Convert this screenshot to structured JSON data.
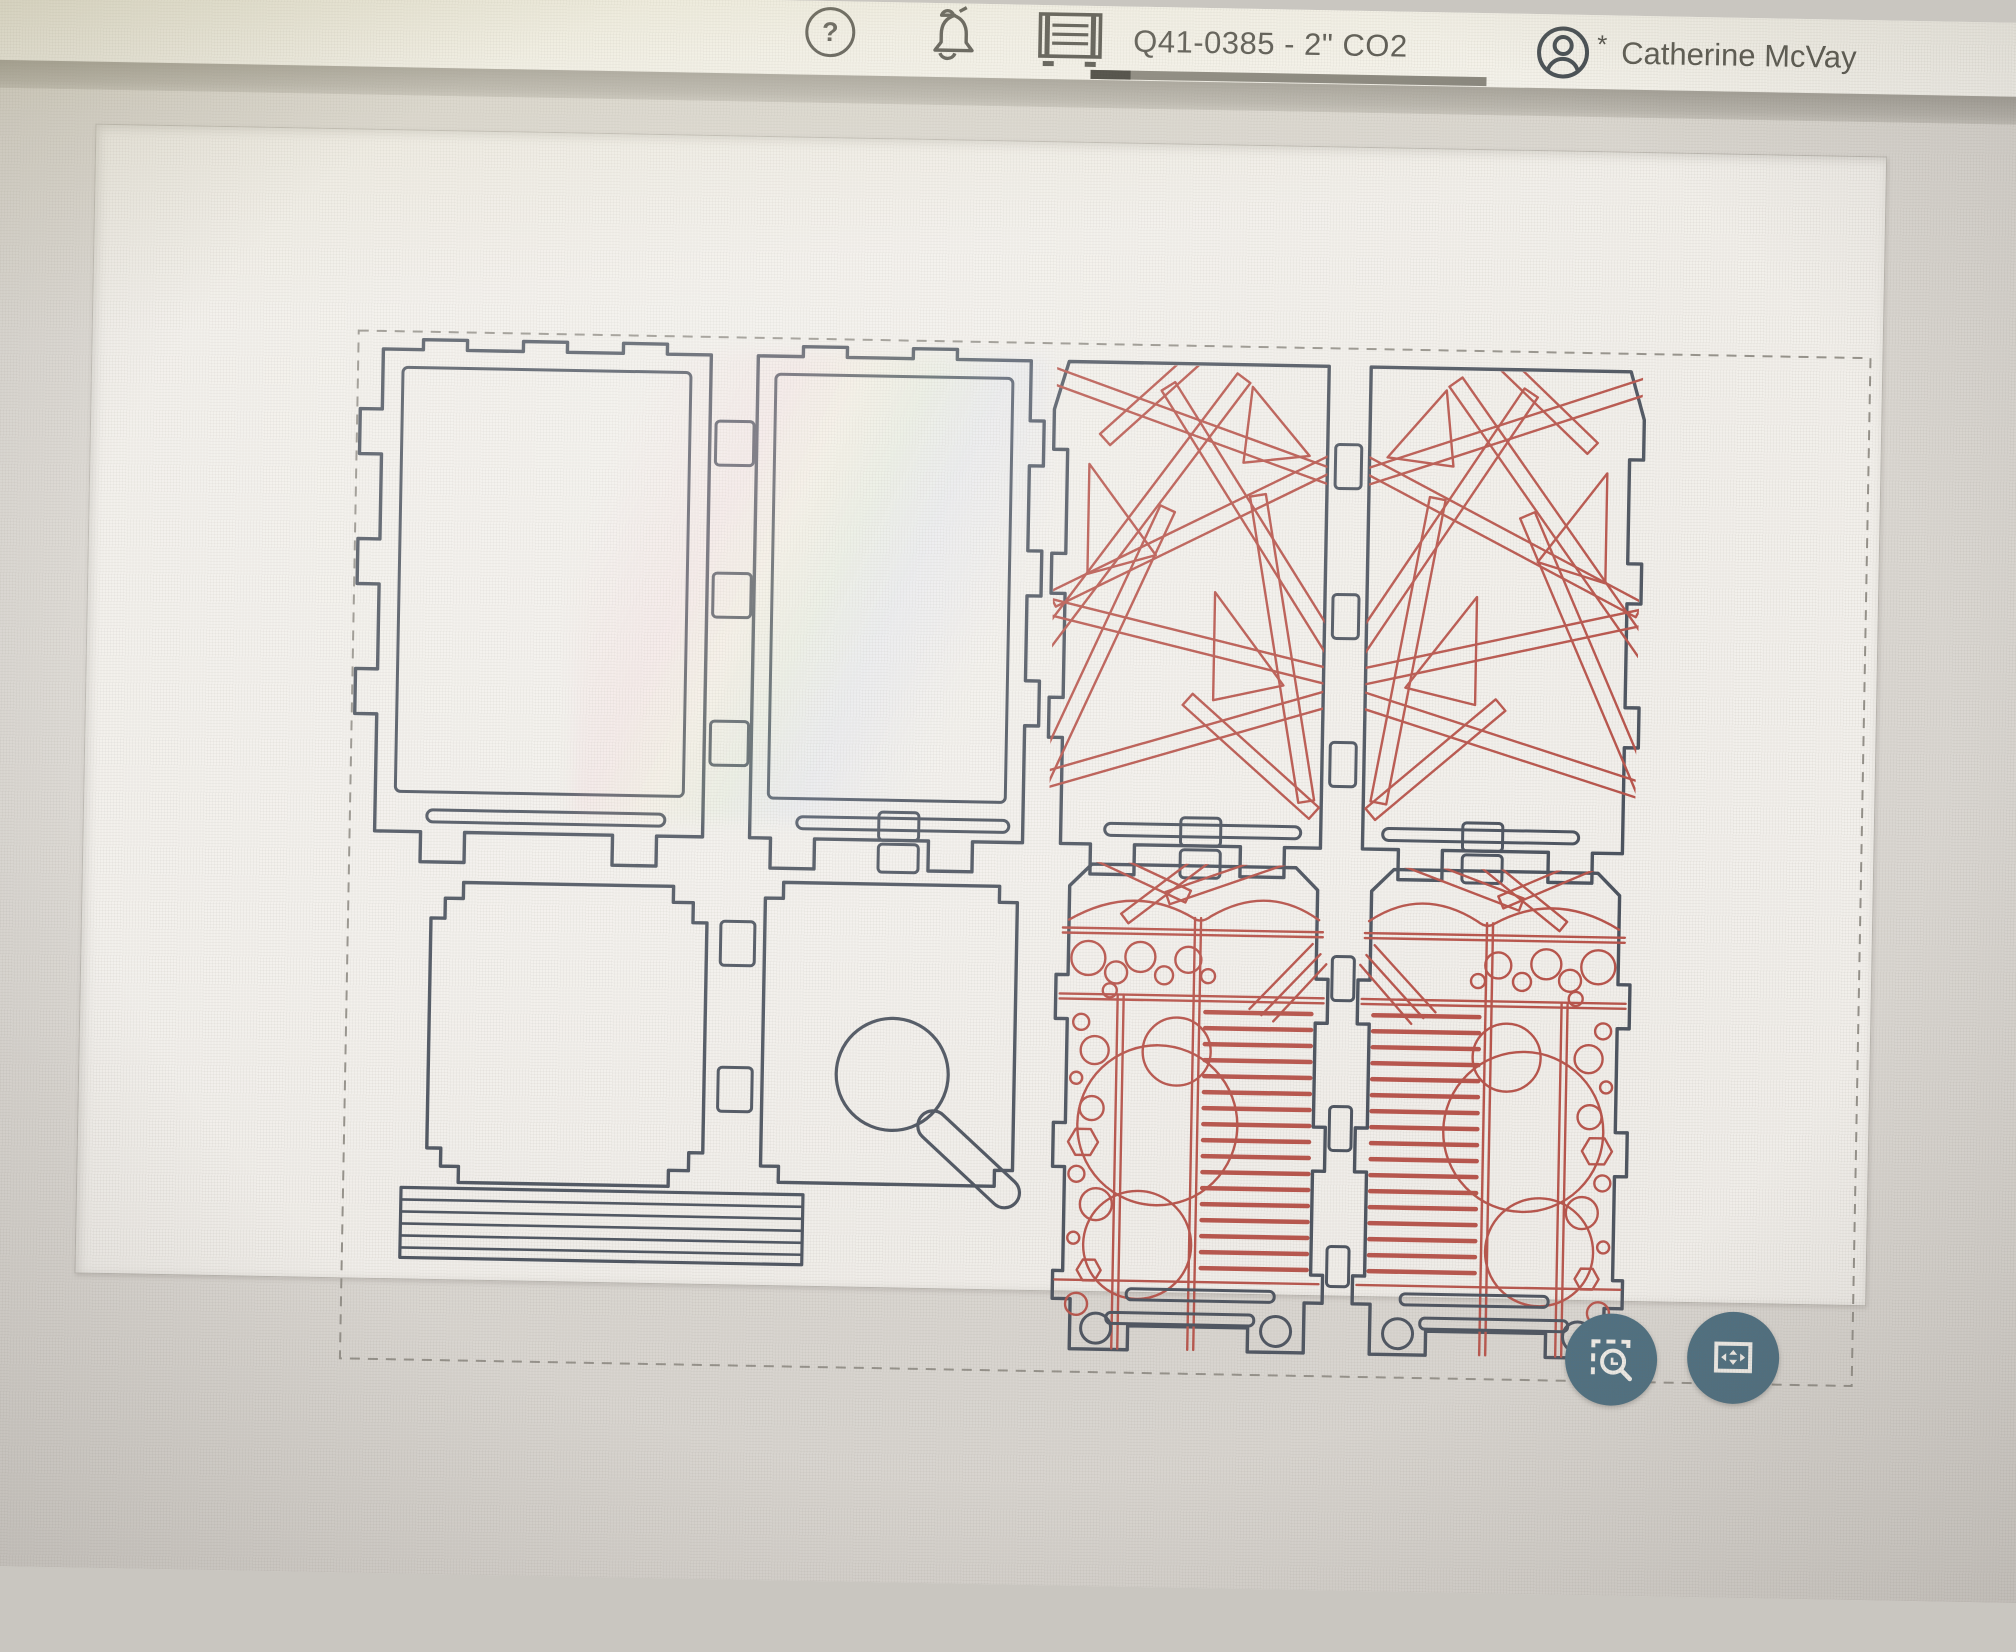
{
  "header": {
    "help_label": "?",
    "icons": {
      "help": "question-circle-icon",
      "notifications": "bell-icon",
      "machine": "laser-machine-icon",
      "account": "account-circle-icon"
    },
    "machine": {
      "label": "Q41-0385 - 2\" CO2",
      "progress_percent": 10
    },
    "user": {
      "name": "Catherine McVay",
      "badge": "*"
    }
  },
  "viewport": {
    "selection_visible": true,
    "controls": [
      {
        "id": "zoom-to-selection",
        "icon": "zoom-area-icon"
      },
      {
        "id": "fit-to-view",
        "icon": "fit-screen-icon"
      }
    ]
  },
  "design": {
    "panels": [
      "lid-panel",
      "lid-panel",
      "decor-lattice-panel",
      "decor-lattice-panel",
      "base-panel",
      "base-panel-keyhole",
      "decor-side-panel",
      "decor-side-panel"
    ],
    "strip_count": 6
  },
  "colors": {
    "cut": "#3d4654",
    "engrave": "#b5473e",
    "button": "#3e6478",
    "band": "#a8a59f",
    "header_bg": "#fbfaf6",
    "canvas_bg": "#dad7d2",
    "workarea_bg": "#f4f2ee",
    "text": "#3b3b39"
  }
}
